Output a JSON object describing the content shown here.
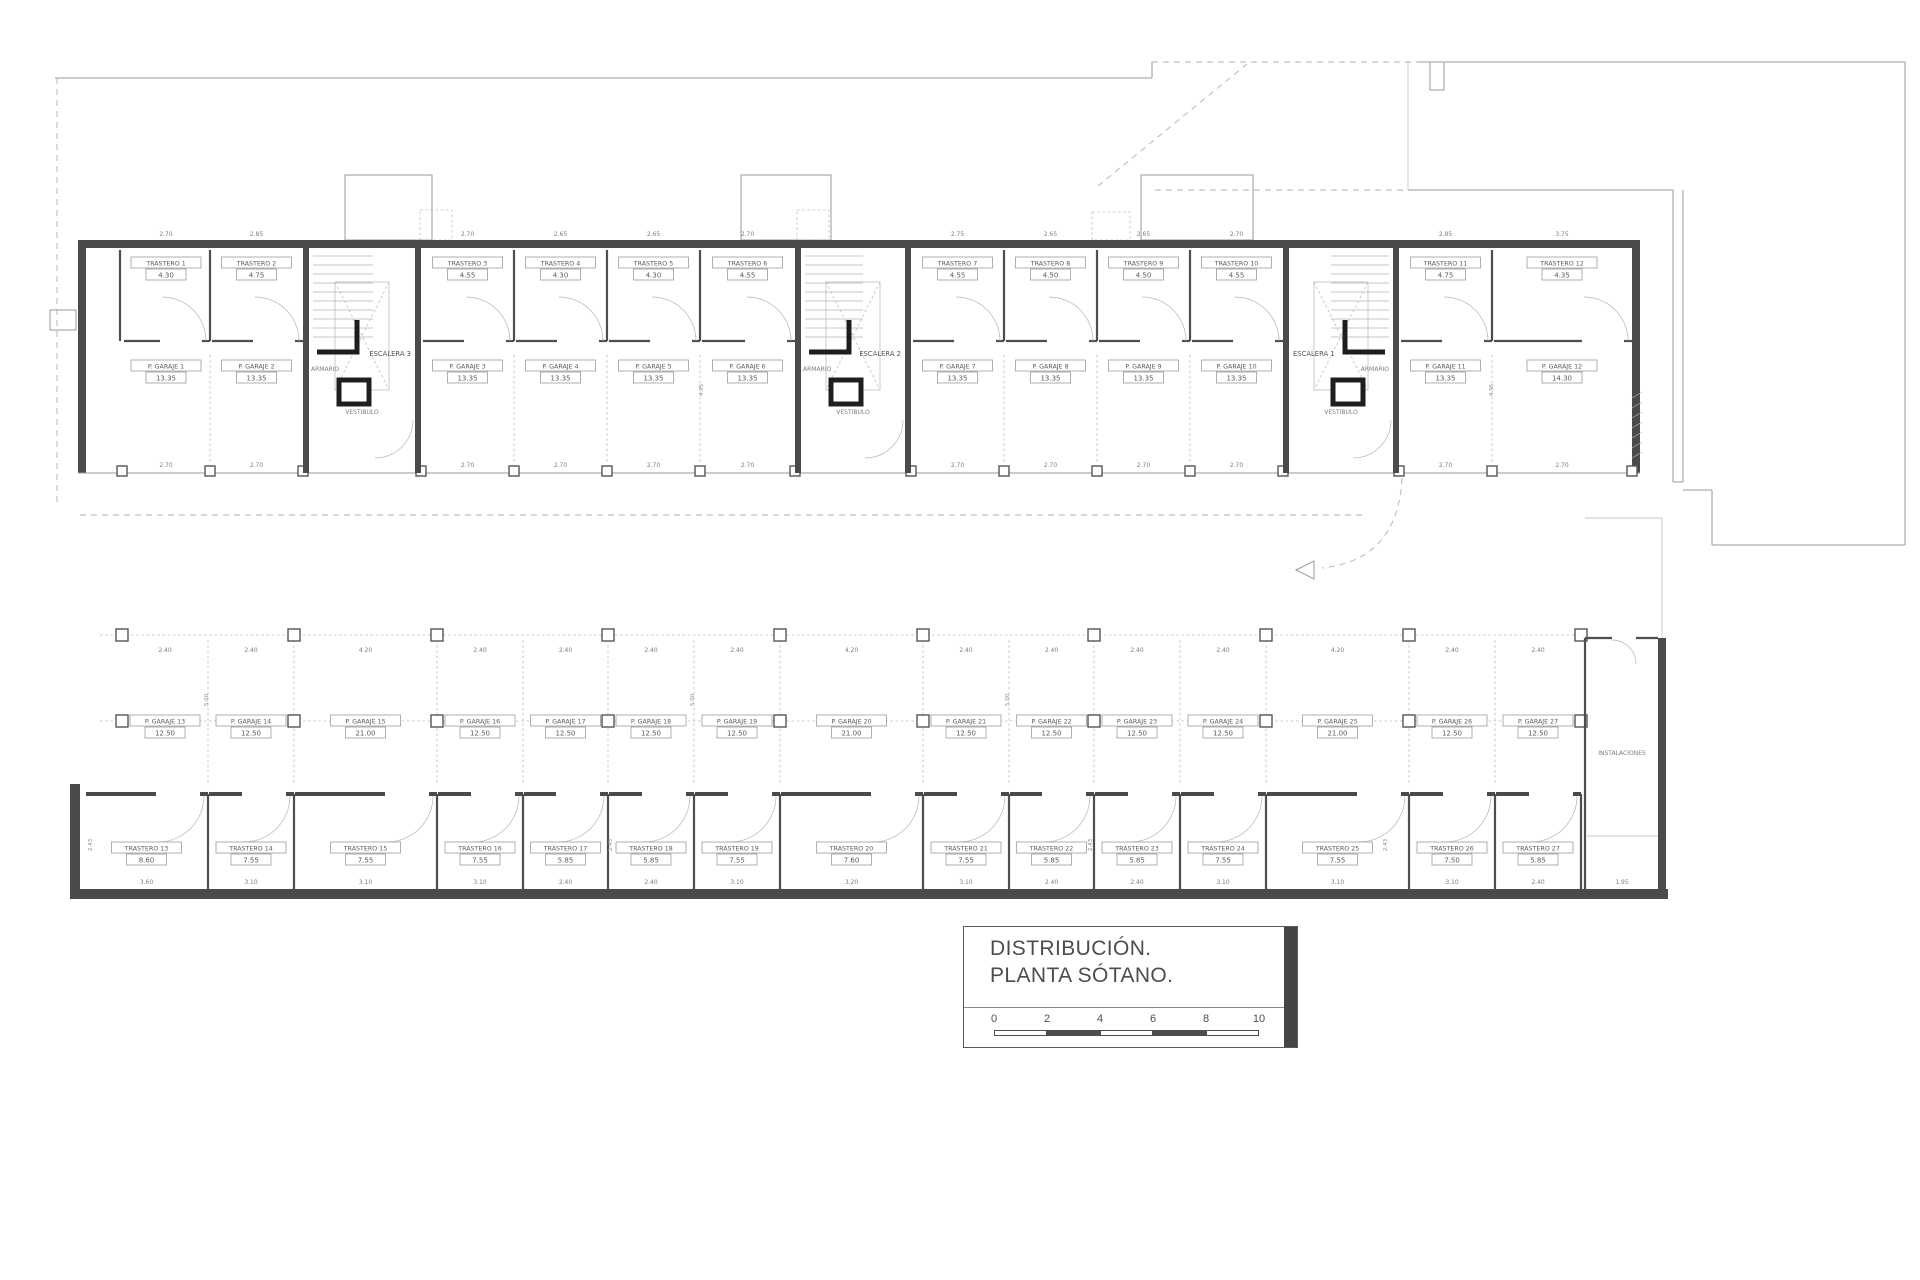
{
  "title_block": {
    "line1": "DISTRIBUCIÓN.",
    "line2": "PLANTA SÓTANO.",
    "scale_numbers": [
      "0",
      "2",
      "4",
      "6",
      "8",
      "10"
    ]
  },
  "plan": {
    "core_labels": [
      {
        "stair": "ESCALERA 1",
        "armario": "ARMARIO",
        "vestibulo": "VESTIBULO"
      },
      {
        "stair": "ESCALERA 2",
        "armario": "ARMARIO",
        "vestibulo": "VESTIBULO"
      },
      {
        "stair": "ESCALERA 3",
        "armario": "ARMARIO",
        "vestibulo": "VESTIBULO"
      }
    ],
    "instalaciones": {
      "label": "INSTALACIONES",
      "dim": "1.95"
    },
    "top_band": {
      "front_dim": "2.70",
      "depth_dim": "4.95",
      "trasteros": [
        {
          "name": "TRASTERO 1",
          "area": "4.30",
          "dim": "2.70"
        },
        {
          "name": "TRASTERO 2",
          "area": "4.75",
          "dim": "2.85"
        },
        {
          "name": "TRASTERO 3",
          "area": "4.55",
          "dim": "2.70"
        },
        {
          "name": "TRASTERO 4",
          "area": "4.30",
          "dim": "2.65"
        },
        {
          "name": "TRASTERO 5",
          "area": "4.30",
          "dim": "2.65"
        },
        {
          "name": "TRASTERO 6",
          "area": "4.55",
          "dim": "2.70"
        },
        {
          "name": "TRASTERO 7",
          "area": "4.55",
          "dim": "2.75"
        },
        {
          "name": "TRASTERO 8",
          "area": "4.50",
          "dim": "2.65"
        },
        {
          "name": "TRASTERO 9",
          "area": "4.50",
          "dim": "2.65"
        },
        {
          "name": "TRASTERO 10",
          "area": "4.55",
          "dim": "2.70"
        },
        {
          "name": "TRASTERO 11",
          "area": "4.75",
          "dim": "2.85"
        },
        {
          "name": "TRASTERO 12",
          "area": "4.35",
          "dim": "3.75"
        }
      ],
      "garajes": [
        {
          "name": "P. GARAJE 1",
          "area": "13.35"
        },
        {
          "name": "P. GARAJE 2",
          "area": "13.35"
        },
        {
          "name": "P. GARAJE 3",
          "area": "13.35"
        },
        {
          "name": "P. GARAJE 4",
          "area": "13.35"
        },
        {
          "name": "P. GARAJE 5",
          "area": "13.35"
        },
        {
          "name": "P. GARAJE 6",
          "area": "13.35"
        },
        {
          "name": "P. GARAJE 7",
          "area": "13.35"
        },
        {
          "name": "P. GARAJE 8",
          "area": "13.35"
        },
        {
          "name": "P. GARAJE 9",
          "area": "13.35"
        },
        {
          "name": "P. GARAJE 10",
          "area": "13.35"
        },
        {
          "name": "P. GARAJE 11",
          "area": "13.35"
        },
        {
          "name": "P. GARAJE 12",
          "area": "14.30"
        }
      ]
    },
    "middle_band": {
      "depth_dim": "5.00",
      "garajes": [
        {
          "name": "P. GARAJE 13",
          "area": "12.50",
          "dim": "2.40"
        },
        {
          "name": "P. GARAJE 14",
          "area": "12.50",
          "dim": "2.40"
        },
        {
          "name": "P. GARAJE 15",
          "area": "21.00",
          "dim": "4.20"
        },
        {
          "name": "P. GARAJE 16",
          "area": "12.50",
          "dim": "2.40"
        },
        {
          "name": "P. GARAJE 17",
          "area": "12.50",
          "dim": "2.40"
        },
        {
          "name": "P. GARAJE 18",
          "area": "12.50",
          "dim": "2.40"
        },
        {
          "name": "P. GARAJE 19",
          "area": "12.50",
          "dim": "2.40"
        },
        {
          "name": "P. GARAJE 20",
          "area": "21.00",
          "dim": "4.20"
        },
        {
          "name": "P. GARAJE 21",
          "area": "12.50",
          "dim": "2.40"
        },
        {
          "name": "P. GARAJE 22",
          "area": "12.50",
          "dim": "2.40"
        },
        {
          "name": "P. GARAJE 23",
          "area": "12.50",
          "dim": "2.40"
        },
        {
          "name": "P. GARAJE 24",
          "area": "12.50",
          "dim": "2.40"
        },
        {
          "name": "P. GARAJE 25",
          "area": "21.00",
          "dim": "4.20"
        },
        {
          "name": "P. GARAJE 26",
          "area": "12.50",
          "dim": "2.40"
        },
        {
          "name": "P. GARAJE 27",
          "area": "12.50",
          "dim": "2.40"
        }
      ]
    },
    "bottom_band": {
      "depth_dim": "2.43",
      "trasteros": [
        {
          "name": "TRASTERO 13",
          "area": "8.60",
          "dim": "3.60"
        },
        {
          "name": "TRASTERO 14",
          "area": "7.55",
          "dim": "3.10"
        },
        {
          "name": "TRASTERO 15",
          "area": "7.55",
          "dim": "3.10"
        },
        {
          "name": "TRASTERO 16",
          "area": "7.55",
          "dim": "3.10"
        },
        {
          "name": "TRASTERO 17",
          "area": "5.85",
          "dim": "2.40"
        },
        {
          "name": "TRASTERO 18",
          "area": "5.85",
          "dim": "2.40"
        },
        {
          "name": "TRASTERO 19",
          "area": "7.55",
          "dim": "3.10"
        },
        {
          "name": "TRASTERO 20",
          "area": "7.60",
          "dim": "3.20"
        },
        {
          "name": "TRASTERO 21",
          "area": "7.55",
          "dim": "3.10"
        },
        {
          "name": "TRASTERO 22",
          "area": "5.85",
          "dim": "2.40"
        },
        {
          "name": "TRASTERO 23",
          "area": "5.85",
          "dim": "2.40"
        },
        {
          "name": "TRASTERO 24",
          "area": "7.55",
          "dim": "3.10"
        },
        {
          "name": "TRASTERO 25",
          "area": "7.55",
          "dim": "3.10"
        },
        {
          "name": "TRASTERO 26",
          "area": "7.50",
          "dim": "3.10"
        },
        {
          "name": "TRASTERO 27",
          "area": "5.85",
          "dim": "2.40"
        }
      ]
    }
  }
}
